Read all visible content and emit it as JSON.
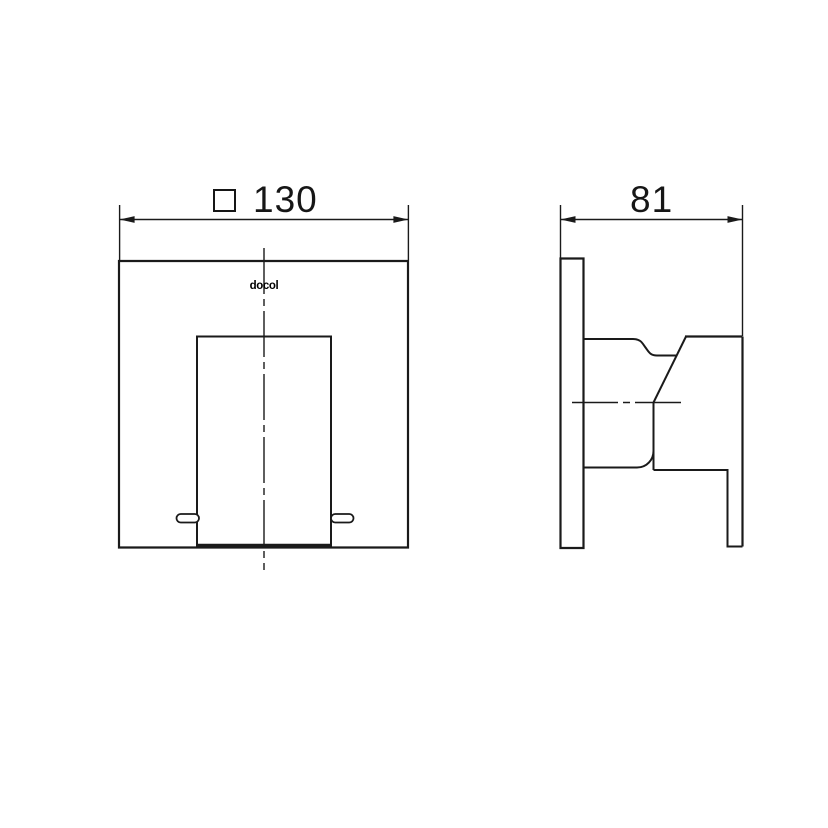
{
  "page": {
    "background": "#ffffff",
    "line_color": "#1a1a1a"
  },
  "front_view": {
    "dimension": {
      "symbol_icon": "square-outline",
      "value": "130"
    },
    "logo_text": "docol"
  },
  "side_view": {
    "dimension": {
      "value": "81"
    }
  }
}
